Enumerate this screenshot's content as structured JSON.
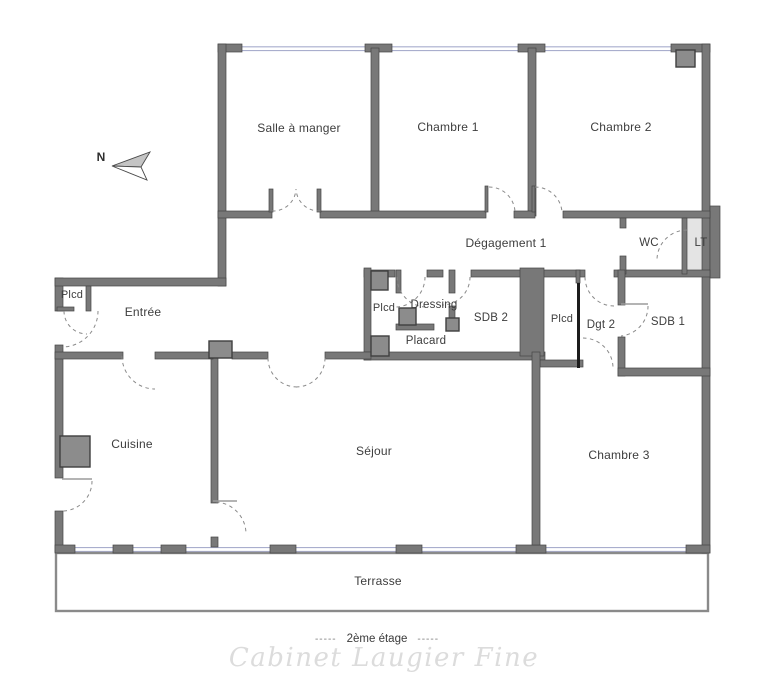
{
  "plan": {
    "compass": {
      "north_label": "N"
    },
    "rooms": {
      "salle_a_manger": {
        "label": "Salle à manger"
      },
      "chambre_1": {
        "label": "Chambre 1"
      },
      "chambre_2": {
        "label": "Chambre 2"
      },
      "degagement_1": {
        "label": "Dégagement 1"
      },
      "wc": {
        "label": "WC"
      },
      "lt": {
        "label": "LT"
      },
      "plcd_entree": {
        "label": "Plcd"
      },
      "entree": {
        "label": "Entrée"
      },
      "plcd_dressing": {
        "label": "Plcd"
      },
      "dressing": {
        "label": "Dressing"
      },
      "sdb_2": {
        "label": "SDB 2"
      },
      "placard": {
        "label": "Placard"
      },
      "plcd_hall": {
        "label": "Plcd"
      },
      "dgt_2": {
        "label": "Dgt 2"
      },
      "sdb_1": {
        "label": "SDB 1"
      },
      "cuisine": {
        "label": "Cuisine"
      },
      "sejour": {
        "label": "Séjour"
      },
      "chambre_3": {
        "label": "Chambre 3"
      },
      "terrasse": {
        "label": "Terrasse"
      }
    },
    "footer": {
      "dash_left": "-----",
      "floor_label": "2ème étage",
      "dash_right": "-----",
      "watermark": "Cabinet Laugier Fine"
    },
    "colors": {
      "wall": "#787878",
      "wall_outline": "#454545",
      "duct_fill": "#8c8c8c",
      "window_glazing": "#a9aecd",
      "lt_room_fill": "#e4e4e4",
      "door_arc": "#8a8a8a",
      "sliding_door": "#1c1c1c",
      "label_text": "#3d3d3d",
      "watermark_text": "#dcdcdc"
    }
  }
}
